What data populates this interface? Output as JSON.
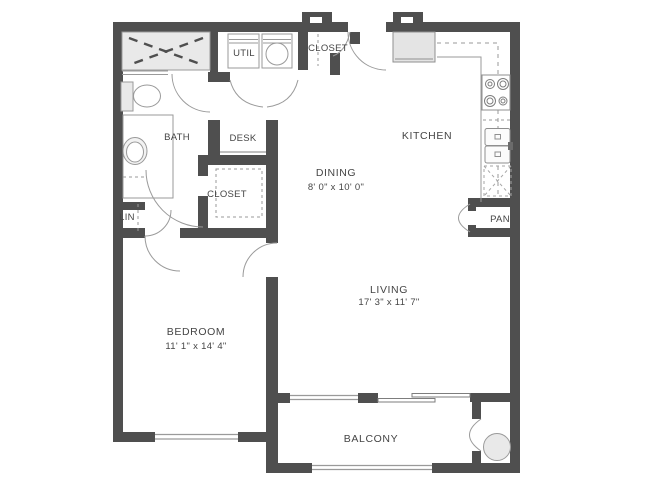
{
  "plan_title": "One-bedroom apartment floor plan",
  "colors": {
    "wall": "#4f4f4f",
    "thin_line": "#9a9a9a",
    "fixture_fill": "#e9e9e9",
    "text": "#454545",
    "background": "#ffffff"
  },
  "rooms": {
    "bath": {
      "label": "BATH"
    },
    "desk": {
      "label": "DESK"
    },
    "utility": {
      "label": "UTIL"
    },
    "entry_closet": {
      "label": "CLOSET"
    },
    "kitchen": {
      "label": "KITCHEN"
    },
    "dining": {
      "label": "DINING",
      "dimensions": "8' 0\" x 10' 0\""
    },
    "bedroom_closet": {
      "label": "CLOSET"
    },
    "linen": {
      "label": "LIN"
    },
    "pantry": {
      "label": "PAN"
    },
    "living": {
      "label": "LIVING",
      "dimensions": "17' 3\" x 11' 7\""
    },
    "bedroom": {
      "label": "BEDROOM",
      "dimensions": "11' 1\" x 14' 4\""
    },
    "balcony": {
      "label": "BALCONY"
    }
  },
  "fixtures": [
    "shower-icon",
    "toilet-icon",
    "vanity-sink-icon",
    "washer-icon",
    "dryer-icon",
    "refrigerator-icon",
    "stove-icon",
    "kitchen-sink-icon",
    "dishwasher-icon",
    "water-heater-icon"
  ]
}
